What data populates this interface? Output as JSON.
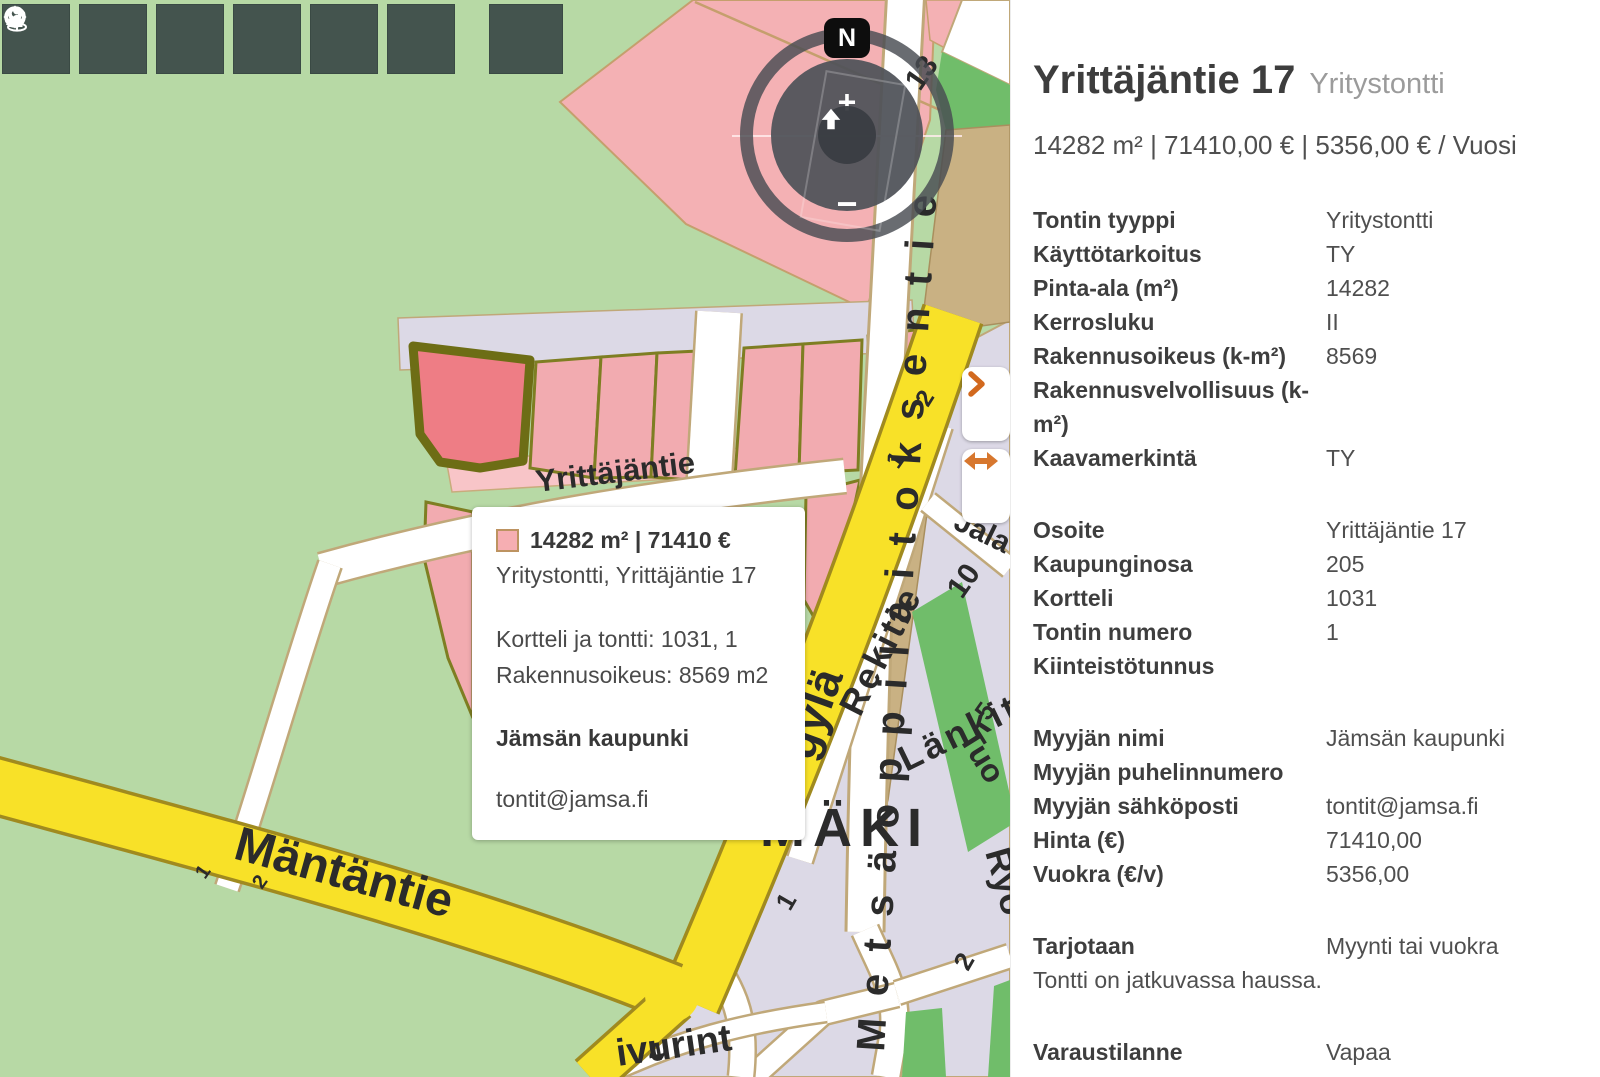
{
  "toolbar": {
    "buttons": [
      {
        "name": "home",
        "icon": "home-icon"
      },
      {
        "name": "contrast",
        "icon": "contrast-icon"
      },
      {
        "name": "measure",
        "icon": "ruler-icon"
      },
      {
        "name": "text-label",
        "icon": "letter-a-icon",
        "text": "A"
      },
      {
        "name": "pan",
        "icon": "pan-move-icon"
      },
      {
        "name": "location",
        "icon": "location-pin-icon"
      },
      {
        "name": "street-view",
        "icon": "street-view-icon"
      }
    ]
  },
  "compass": {
    "north": "N",
    "zoom_in": "+",
    "zoom_out": "−",
    "center_icon": "up-arrow-icon"
  },
  "map": {
    "street_labels": [
      "Yrittäjäntie",
      "Mäntäntie",
      "Metsäoppilaitoksentie",
      "Rekitie",
      "Länkit",
      "Jala",
      "Tuo",
      "Ryö",
      "ivurint",
      "gylä"
    ],
    "area_label": "MÄKI",
    "lot_numbers": [
      "13",
      "2",
      "1",
      "10",
      "5",
      "1",
      "2",
      "4",
      "1",
      "2"
    ],
    "popup": {
      "title": "14282 m² | 71410 €",
      "subtitle": "Yritystontti, Yrittäjäntie 17",
      "line1": "Kortteli ja tontti: 1031, 1",
      "line2": "Rakennusoikeus: 8569 m2",
      "seller": "Jämsän kaupunki",
      "email": "tontit@jamsa.fi",
      "swatch_color": "#f6aeb2"
    }
  },
  "side_buttons": [
    {
      "name": "expand-panel",
      "icon": "chevron-right-icon"
    },
    {
      "name": "swap-view",
      "icon": "double-arrow-icon"
    }
  ],
  "panel": {
    "title": "Yrittäjäntie 17",
    "subtitle": "Yritystontti",
    "summary": "14282 m² | 71410,00 € | 5356,00 € / Vuosi",
    "sections": [
      {
        "rows": [
          {
            "label": "Tontin tyyppi",
            "value": "Yritystontti"
          },
          {
            "label": "Käyttötarkoitus",
            "value": "TY"
          },
          {
            "label": "Pinta-ala (m²)",
            "value": "14282"
          },
          {
            "label": "Kerrosluku",
            "value": "II"
          },
          {
            "label": "Rakennusoikeus (k-m²)",
            "value": "8569"
          },
          {
            "label": "Rakennusvelvollisuus (k-m²)",
            "value": ""
          },
          {
            "label": "Kaavamerkintä",
            "value": "TY"
          }
        ]
      },
      {
        "rows": [
          {
            "label": "Osoite",
            "value": "Yrittäjäntie 17"
          },
          {
            "label": "Kaupunginosa",
            "value": "205"
          },
          {
            "label": "Kortteli",
            "value": "1031"
          },
          {
            "label": "Tontin numero",
            "value": "1"
          },
          {
            "label": "Kiinteistötunnus",
            "value": ""
          }
        ]
      },
      {
        "rows": [
          {
            "label": "Myyjän nimi",
            "value": "Jämsän kaupunki"
          },
          {
            "label": "Myyjän puhelinnumero",
            "value": ""
          },
          {
            "label": "Myyjän sähköposti",
            "value": "tontit@jamsa.fi"
          },
          {
            "label": "Hinta (€)",
            "value": "71410,00"
          },
          {
            "label": "Vuokra (€/v)",
            "value": "5356,00"
          }
        ]
      },
      {
        "rows": [
          {
            "label": "Tarjotaan",
            "value": "Myynti tai vuokra"
          }
        ],
        "note": "Tontti on jatkuvassa haussa."
      },
      {
        "rows": [
          {
            "label": "Varaustilanne",
            "value": "Vapaa"
          }
        ]
      }
    ]
  },
  "colors": {
    "accent_orange": "#d7772e",
    "toolbar_button": "#44544e",
    "selected_parcel": "#ee7d85",
    "parcel_pink": "#f2abb0",
    "road_yellow": "#f8e128",
    "map_green": "#b7d9a5",
    "urban_lavender": "#dcd9e6",
    "panel_title": "#3d3d3d"
  }
}
